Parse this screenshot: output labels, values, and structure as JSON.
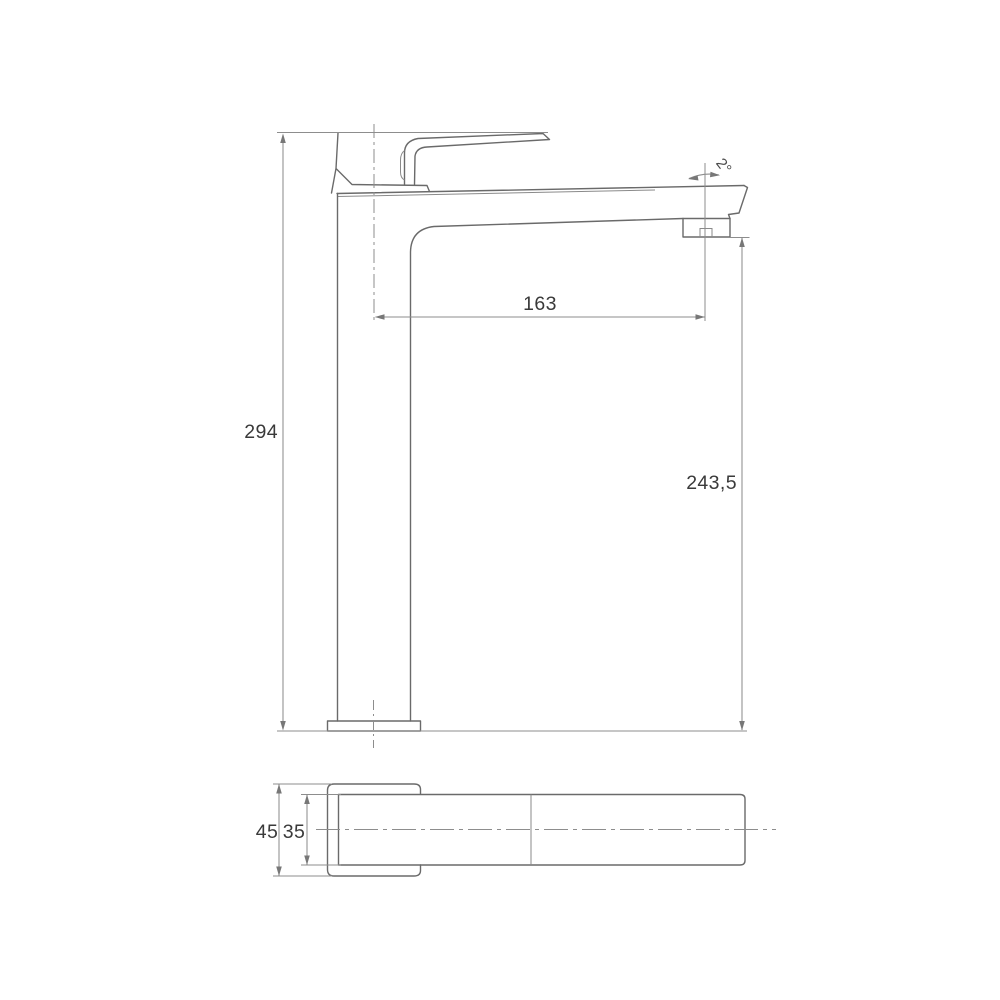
{
  "colors": {
    "background": "#ffffff",
    "outline": "#6a6a6a",
    "dimension_lines": "#8d8d8d",
    "label_text": "#3a3a3a"
  },
  "dimensions": {
    "overall_height": "294",
    "spout_reach": "163",
    "spout_outlet_height": "243,5",
    "spout_angle": "2°",
    "base_width": "45",
    "spout_width": "35"
  }
}
